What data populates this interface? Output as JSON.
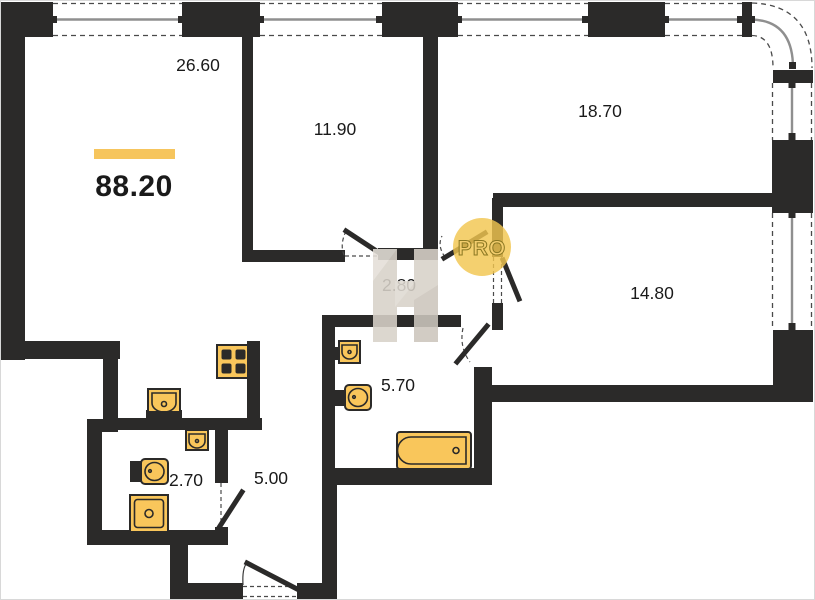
{
  "floorplan": {
    "title_total_area": "88.20",
    "rooms": {
      "living_kitchen": {
        "area": "26.60"
      },
      "bedroom_left": {
        "area": "11.90"
      },
      "bedroom_top": {
        "area": "18.70"
      },
      "bedroom_right": {
        "area": "14.80"
      },
      "hall": {
        "area": "2.80"
      },
      "bathroom": {
        "area": "5.70"
      },
      "corridor": {
        "area": "5.00"
      },
      "wc": {
        "area": "2.70"
      }
    },
    "watermarks": {
      "badge": "PRO",
      "logo_letter": "Н"
    },
    "colors": {
      "walls": "#2b2a29",
      "fixture_fill": "#f9c65b",
      "fixture_stroke": "#2b2a29",
      "accent_bar": "#f6c55d",
      "pro_circle": "#f2c64f",
      "pro_text": "#8a7722",
      "watermark": "#d8d2c9",
      "window_line": "#8f8f8f",
      "dash_line": "#4a4a4a",
      "label_text": "#1a1a1a",
      "background": "#ffffff"
    }
  }
}
